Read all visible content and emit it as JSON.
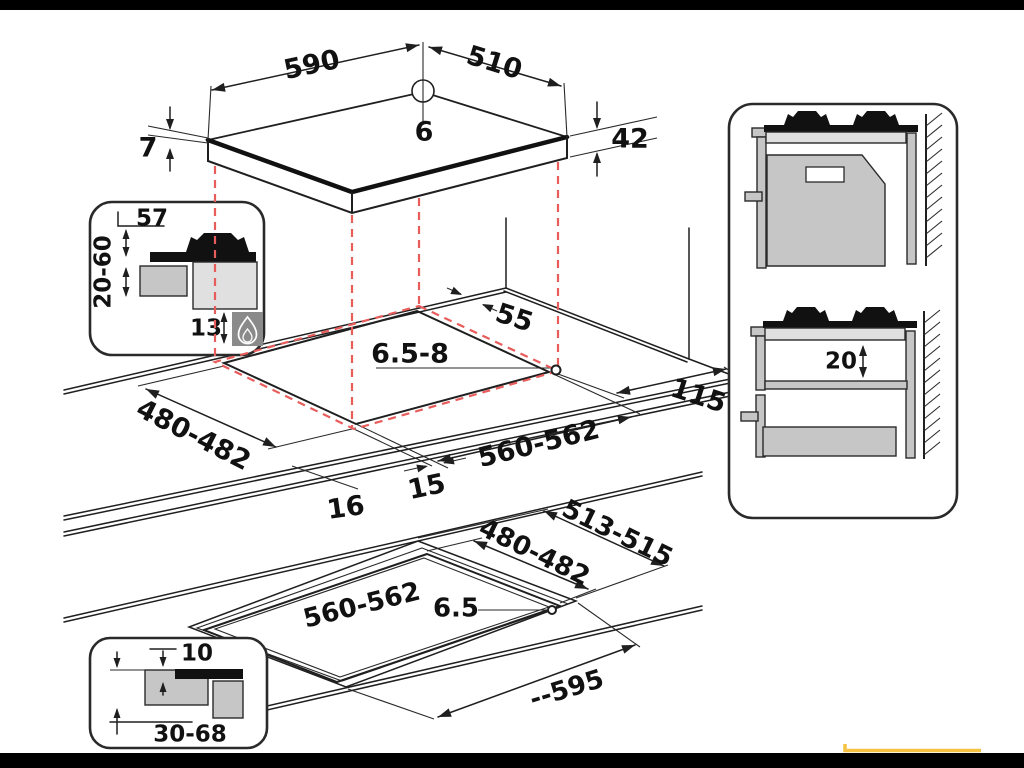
{
  "top_view": {
    "width": "590",
    "depth": "510",
    "hole_diameter": "6",
    "glass_thickness": "7",
    "body_height": "42"
  },
  "burner_detail_inset": {
    "top_clearance": "57",
    "cabinet_distance": "20-60",
    "bottom_clearance": "13",
    "icon": "gas-flame-icon"
  },
  "worktop_cutout_view": {
    "rear_clearance": "55",
    "hole_diameter": "6.5-8",
    "cutout_depth": "480-482",
    "side_clearance": "115",
    "cutout_width": "560-562",
    "front_overhang": "15",
    "side_overhang": "16"
  },
  "wall_side_view": {
    "shelf_clearance": "20"
  },
  "flush_mount_view": {
    "recess_depth": "513-515",
    "cutout_depth": "480-482",
    "cutout_width": "560-562",
    "hole_diameter": "6.5",
    "recess_width": "--595"
  },
  "flush_detail_inset": {
    "step_depth": "10",
    "worktop_thickness": "30-68"
  },
  "colors": {
    "line": "#1f1f1f",
    "dashed_red": "#e85c5c",
    "accent_yellow": "#f6c244",
    "gray_light": "#e0e0e0",
    "gray_mid": "#c6c6c6",
    "gray_dark": "#8a8a8a"
  }
}
